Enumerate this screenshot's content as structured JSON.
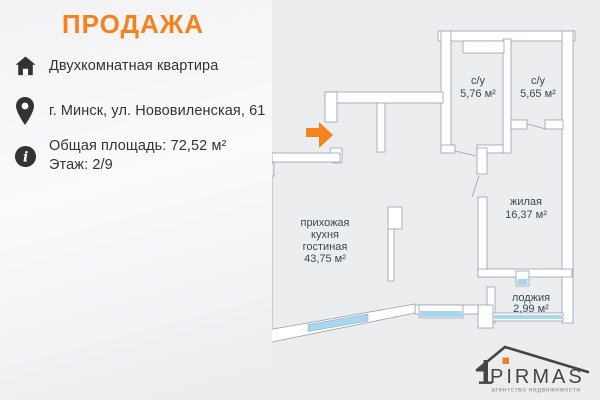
{
  "header": {
    "title": "ПРОДАЖА"
  },
  "property": {
    "type": "Двухкомнатная квартира",
    "address": "г. Минск, ул. Нововиленская, 61",
    "total_area": "Общая площадь: 72,52 м²",
    "floor": "Этаж: 2/9"
  },
  "floor_plan": {
    "rooms": [
      {
        "name": "с/у",
        "area": "5,76 м²"
      },
      {
        "name": "с/у",
        "area": "5,65 м²"
      },
      {
        "name": "жилая",
        "area": "16,37 м²"
      },
      {
        "name": "прихожая кухня гостиная",
        "area": "43,75 м²",
        "lines": [
          "прихожая",
          "кухня",
          "гостиная",
          "43,75 м²"
        ]
      },
      {
        "name": "лоджия",
        "area": "2,99 м²"
      }
    ]
  },
  "logo": {
    "brand": "PIRMAS",
    "tagline": "агентство недвижимости"
  },
  "colors": {
    "accent_orange": "#f5821f",
    "window_blue": "#a9d6ef",
    "wall_fill": "#ffffff",
    "wall_stroke": "#99a1ab",
    "plan_text": "#3d4757",
    "logo_gray": "#454545"
  }
}
